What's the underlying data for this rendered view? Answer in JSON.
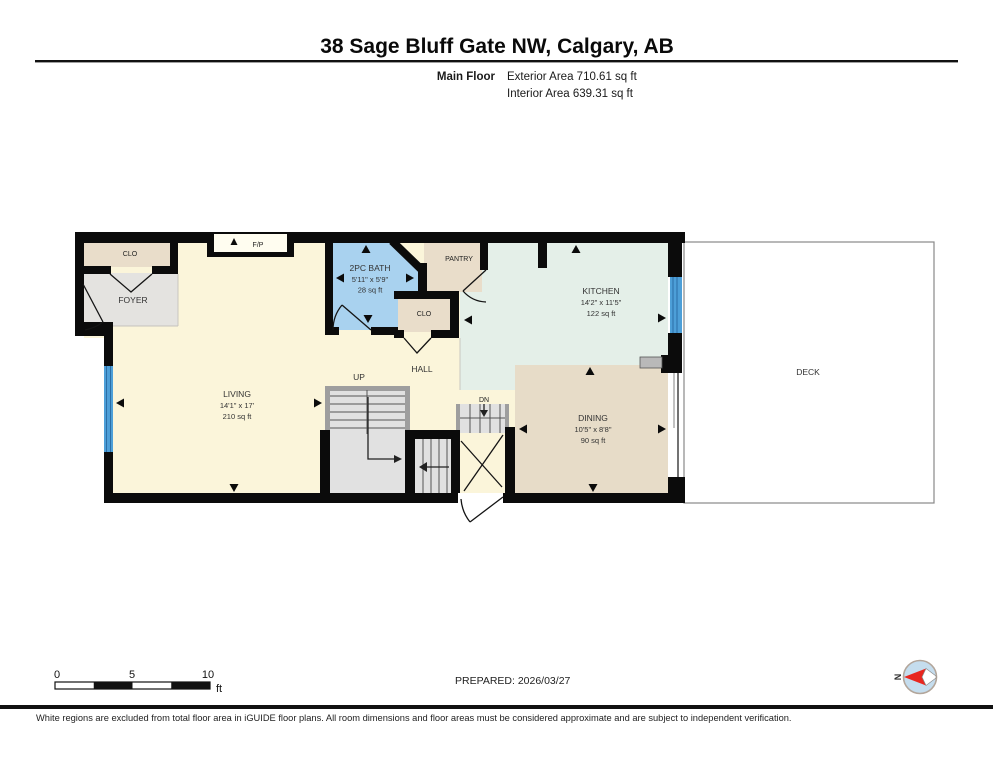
{
  "header": {
    "title": "38 Sage Bluff Gate NW, Calgary, AB",
    "floor_label": "Main Floor",
    "exterior_area": "Exterior Area 710.61 sq ft",
    "interior_area": "Interior Area 639.31 sq ft"
  },
  "rooms": {
    "closet_foyer": {
      "name": "CLO"
    },
    "foyer": {
      "name": "FOYER"
    },
    "fireplace": {
      "name": "F/P"
    },
    "living": {
      "name": "LIVING",
      "dimensions": "14'1\" x 17'",
      "area": "210 sq ft"
    },
    "bath": {
      "name": "2PC BATH",
      "dimensions": "5'11\" x 5'9\"",
      "area": "28 sq ft"
    },
    "pantry": {
      "name": "PANTRY"
    },
    "closet_hall": {
      "name": "CLO"
    },
    "hall": {
      "name": "HALL"
    },
    "stairs_up": {
      "name": "UP"
    },
    "stairs_down": {
      "name": "DN"
    },
    "kitchen": {
      "name": "KITCHEN",
      "dimensions": "14'2\" x 11'5\"",
      "area": "122 sq ft"
    },
    "dining": {
      "name": "DINING",
      "dimensions": "10'5\" x 8'8\"",
      "area": "90 sq ft"
    },
    "deck": {
      "name": "DECK"
    }
  },
  "scale_bar": {
    "tick_0": "0",
    "tick_5": "5",
    "tick_10": "10",
    "unit": "ft"
  },
  "footer": {
    "prepared": "PREPARED: 2026/03/27",
    "north_label": "N",
    "disclaimer": "White regions are excluded from total floor area in iGUIDE floor plans. All room dimensions and floor areas must be considered approximate and are subject to independent verification."
  },
  "colors": {
    "living": "#fbf5da",
    "foyer": "#e4e3e0",
    "closet": "#e9ddca",
    "bath": "#a9d2ef",
    "kitchen": "#e4efe8",
    "dining": "#e7dcc8",
    "stairs": "#e1e1e1",
    "window": "#4d9fd8",
    "deck": "#ffffff",
    "wall": "#0b0b0b",
    "compass_fill": "#c5ddee",
    "compass_needle": "#e8261f"
  }
}
